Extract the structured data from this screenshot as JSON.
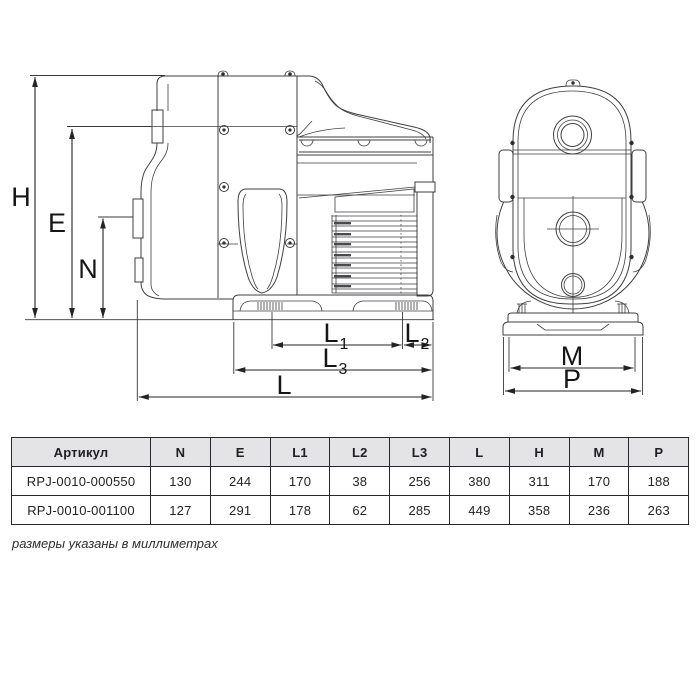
{
  "drawing": {
    "description": "pump technical drawing, side view and front view",
    "dim_labels": {
      "h": "H",
      "e": "E",
      "n": "N",
      "l": "L",
      "m": "M",
      "p": "P",
      "l1": {
        "base": "L",
        "sub": "1"
      },
      "l2": {
        "base": "L",
        "sub": "2"
      },
      "l3": {
        "base": "L",
        "sub": "3"
      }
    }
  },
  "table": {
    "headers": [
      "Артикул",
      "N",
      "E",
      "L1",
      "L2",
      "L3",
      "L",
      "H",
      "M",
      "P"
    ],
    "rows": [
      {
        "cells": [
          "RPJ-0010-000550",
          "130",
          "244",
          "170",
          "38",
          "256",
          "380",
          "311",
          "170",
          "188"
        ]
      },
      {
        "cells": [
          "RPJ-0010-001100",
          "127",
          "291",
          "178",
          "62",
          "285",
          "449",
          "358",
          "236",
          "263"
        ]
      }
    ]
  },
  "footer": {
    "note": "размеры указаны в миллиметрах"
  },
  "colors": {
    "background": "#ffffff",
    "drawing_line": "#3f3f41",
    "dimension_line": "#232325",
    "table_border": "#28282c",
    "table_header_bg": "#e4e4e6",
    "text": "#1c1c1f"
  }
}
